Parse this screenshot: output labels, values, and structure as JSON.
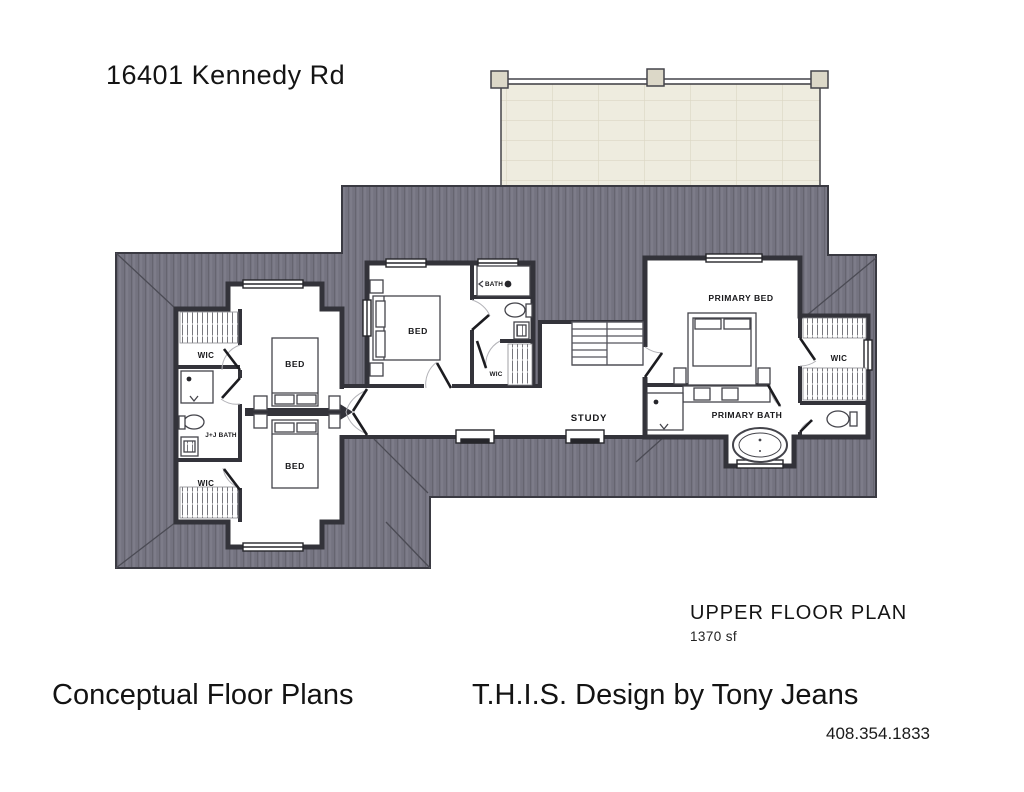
{
  "header": {
    "address": "16401 Kennedy Rd"
  },
  "plan": {
    "name": "UPPER FLOOR PLAN",
    "area_label": "1370 sf",
    "rooms": {
      "wic_left_top": {
        "label": "WIC"
      },
      "jj_bath": {
        "label": "J+J BATH"
      },
      "wic_left_bottom": {
        "label": "WIC"
      },
      "bed_left_top": {
        "label": "BED"
      },
      "bed_left_bottom": {
        "label": "BED"
      },
      "bed_middle": {
        "label": "BED"
      },
      "bath_middle": {
        "label": "BATH"
      },
      "wic_middle": {
        "label": "WIC"
      },
      "study": {
        "label": "STUDY"
      },
      "primary_bed": {
        "label": "PRIMARY BED"
      },
      "primary_bath": {
        "label": "PRIMARY BATH"
      },
      "wic_right": {
        "label": "WIC"
      }
    }
  },
  "footer": {
    "left_title": "Conceptual Floor Plans",
    "designer": "T.H.I.S. Design by Tony Jeans",
    "phone": "408.354.1833"
  },
  "colors": {
    "roof": "#747380",
    "roof_line": "#3a3a42",
    "deck": "#eeecdf",
    "wall": "#33333a",
    "floor": "#ffffff"
  }
}
